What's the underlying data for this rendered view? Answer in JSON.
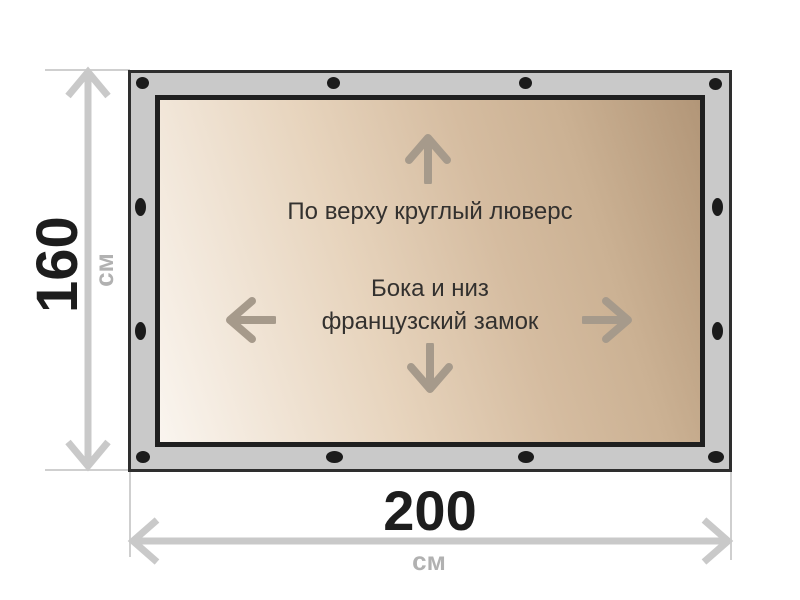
{
  "diagram": {
    "title": "tarpaulin-size-specification",
    "notes": {
      "top": "По верху круглый люверс",
      "sides_line1": "Бока и низ",
      "sides_line2": "французский замок"
    },
    "dimensions": {
      "height": {
        "value": "160",
        "unit": "см"
      },
      "width": {
        "value": "200",
        "unit": "см"
      }
    },
    "grommets_count": 12,
    "icons": {
      "up": "arrow-up-icon",
      "down": "arrow-down-icon",
      "left": "arrow-left-icon",
      "right": "arrow-right-icon",
      "grommet": "grommet-dot-icon",
      "height_dimension": "vertical-dimension-arrow-icon",
      "width_dimension": "horizontal-dimension-arrow-icon"
    },
    "colors": {
      "background": "#ffffff",
      "frame_band": "#c9c9c9",
      "frame_outline": "#2e2e2e",
      "tarp_border": "#1f1f1f",
      "tarp_gradient_light": "#faf5ef",
      "tarp_gradient_mid": "#d5bca0",
      "tarp_gradient_dark": "#b29678",
      "grommet": "#1b1b1b",
      "canvas_arrow": "#a69a8b",
      "dimension_gray": "#c9c9c9",
      "dimension_text": "#1d1d1d",
      "unit_text": "#b1b1b1",
      "note_text": "#33312f"
    }
  }
}
